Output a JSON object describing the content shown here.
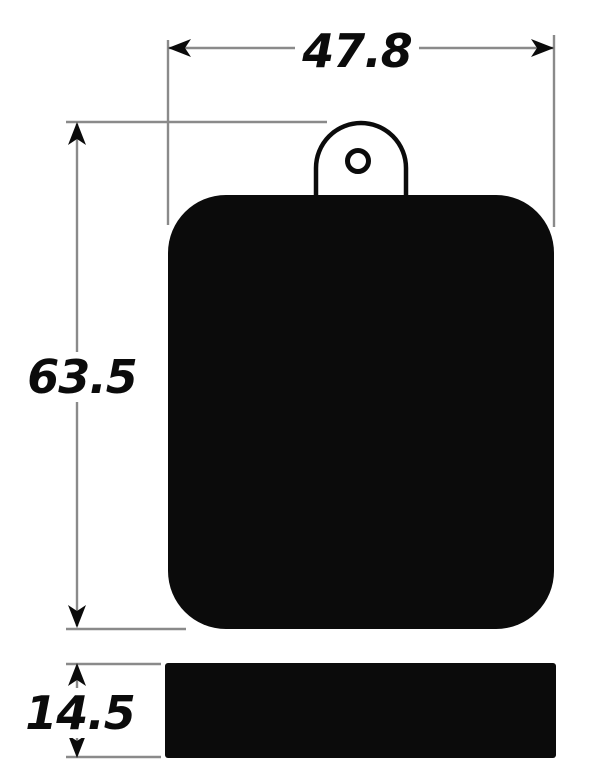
{
  "colors": {
    "ink": "#0b0b0b",
    "line": "#8a8a8a",
    "background": "#ffffff"
  },
  "dimensions": {
    "width": {
      "label": "47.8"
    },
    "height": {
      "label": "63.5"
    },
    "thickness": {
      "label": "14.5"
    }
  }
}
